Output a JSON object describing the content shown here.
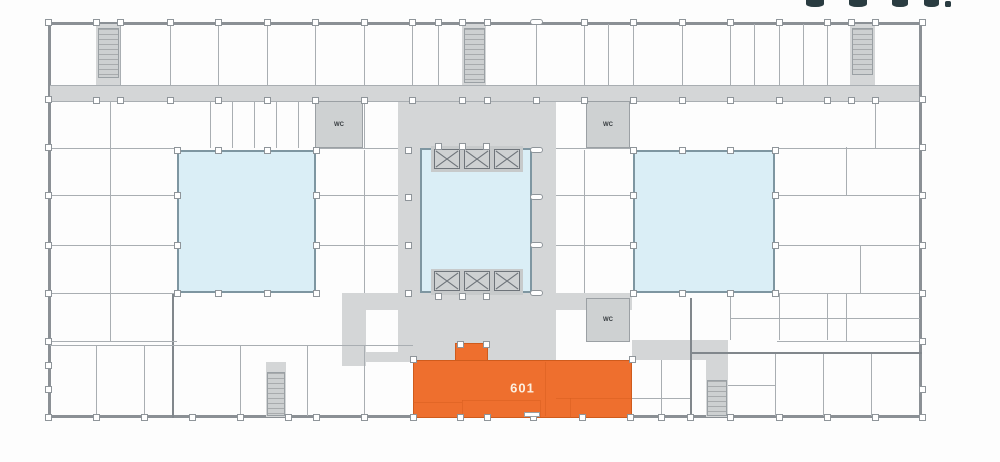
{
  "floor_plan": {
    "unit": {
      "label": "601"
    },
    "wc_labels": [
      "WC",
      "WC",
      "WC"
    ],
    "colors": {
      "highlight": "#ee6f2e",
      "highlight_text": "#fcefe0",
      "atrium": "#daeef6",
      "corridor": "#d4d6d7",
      "outer_wall": "#8b9095",
      "thin_wall": "#a9aeb2",
      "logo": "#2a3c41"
    }
  }
}
